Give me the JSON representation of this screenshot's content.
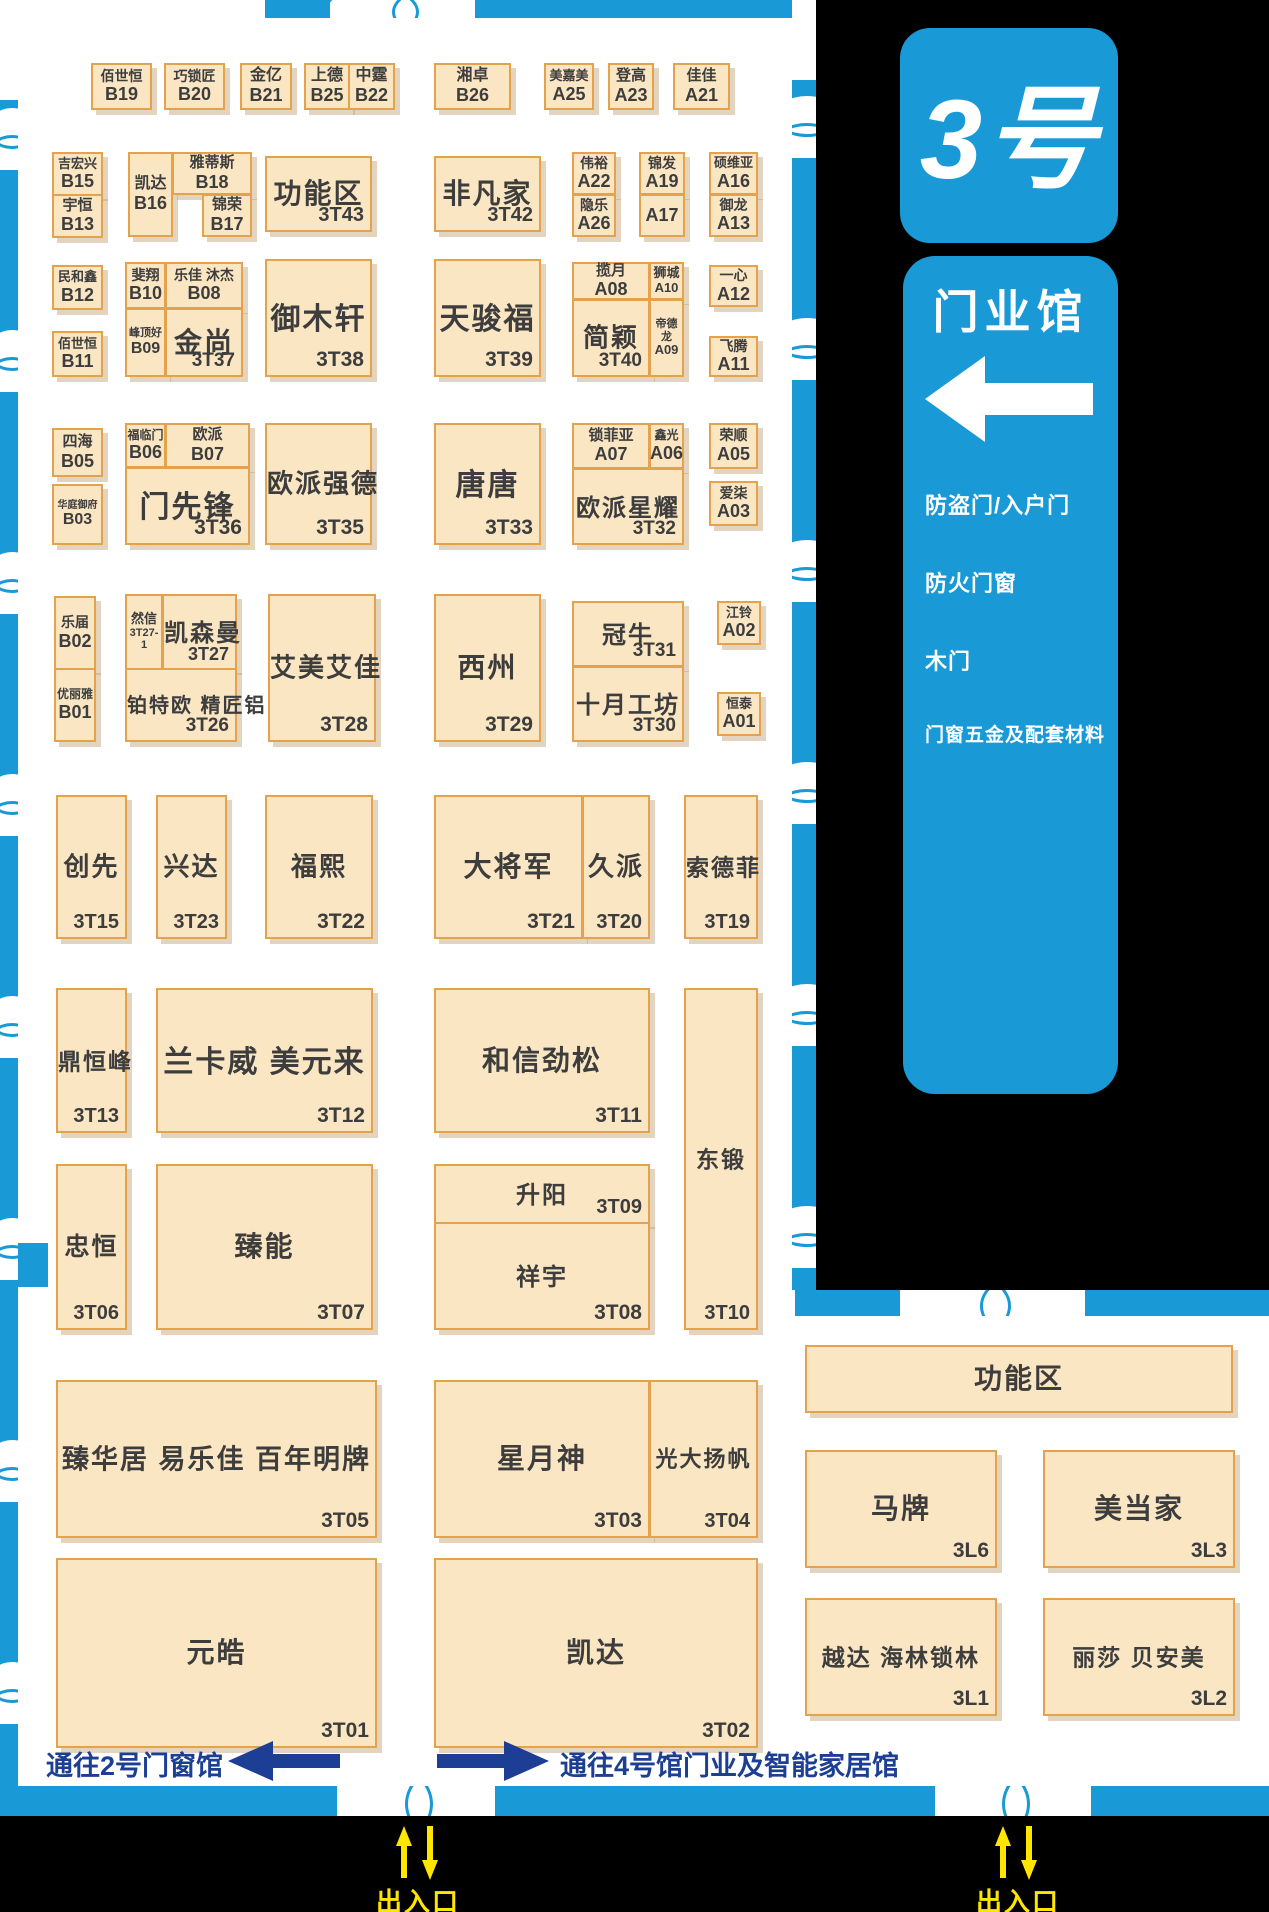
{
  "hall": {
    "number_label": "3号",
    "name": "门业馆",
    "categories": [
      "防盗门/入户门",
      "防火门窗",
      "木门",
      "门窗五金及配套材料"
    ]
  },
  "navigation": {
    "to_hall2": "通往2号门窗馆",
    "to_hall4": "通往4号馆门业及智能家居馆",
    "entrance_label": "出入口"
  },
  "colors": {
    "accent_blue": "#199ad7",
    "navy": "#1c3e94",
    "yellow": "#ffe600",
    "booth_fill": "#fae6c3",
    "booth_border": "#e3a24b",
    "black": "#000000"
  },
  "booths": [
    {
      "id": "B19",
      "name": "佰世恒",
      "x": 91,
      "y": 63,
      "w": 61,
      "h": 47,
      "big": false,
      "fs": 14
    },
    {
      "id": "B20",
      "name": "巧锁匠",
      "x": 164,
      "y": 63,
      "w": 61,
      "h": 47,
      "big": false,
      "fs": 14
    },
    {
      "id": "B21",
      "name": "金亿",
      "x": 240,
      "y": 63,
      "w": 52,
      "h": 47,
      "big": false,
      "fs": 16
    },
    {
      "id": "B25",
      "name": "上德",
      "x": 304,
      "y": 63,
      "w": 46,
      "h": 47,
      "big": false,
      "fs": 16
    },
    {
      "id": "B22",
      "name": "中霆",
      "x": 348,
      "y": 63,
      "w": 47,
      "h": 47,
      "big": false,
      "fs": 16
    },
    {
      "id": "B26",
      "name": "湘卓",
      "x": 434,
      "y": 63,
      "w": 77,
      "h": 47,
      "big": false,
      "fs": 16
    },
    {
      "id": "A25",
      "name": "美嘉美",
      "x": 544,
      "y": 63,
      "w": 50,
      "h": 47,
      "big": false,
      "fs": 13
    },
    {
      "id": "A23",
      "name": "登高",
      "x": 608,
      "y": 63,
      "w": 46,
      "h": 47,
      "big": false,
      "fs": 15
    },
    {
      "id": "A21",
      "name": "佳佳",
      "x": 673,
      "y": 63,
      "w": 57,
      "h": 47,
      "big": false,
      "fs": 15
    },
    {
      "id": "B15",
      "name": "吉宏兴",
      "x": 52,
      "y": 152,
      "w": 51,
      "h": 44,
      "big": false,
      "fs": 13
    },
    {
      "id": "B13",
      "name": "宇恒",
      "x": 52,
      "y": 194,
      "w": 51,
      "h": 44,
      "big": false,
      "fs": 15
    },
    {
      "id": "B16",
      "name": "凯达",
      "x": 128,
      "y": 152,
      "w": 45,
      "h": 85,
      "big": false,
      "fs": 16
    },
    {
      "id": "B18",
      "name": "雅蒂斯",
      "x": 172,
      "y": 152,
      "w": 80,
      "h": 43,
      "big": false,
      "fs": 15
    },
    {
      "id": "B17",
      "name": "锦荣",
      "x": 202,
      "y": 194,
      "w": 50,
      "h": 43,
      "big": false,
      "fs": 15
    },
    {
      "id": "3T43",
      "name": "功能区",
      "x": 265,
      "y": 156,
      "w": 107,
      "h": 76,
      "big": true,
      "fs": 28,
      "ifs": 20
    },
    {
      "id": "3T42",
      "name": "非凡家",
      "x": 434,
      "y": 156,
      "w": 107,
      "h": 76,
      "big": true,
      "fs": 28,
      "ifs": 20
    },
    {
      "id": "A22",
      "name": "伟裕",
      "x": 572,
      "y": 152,
      "w": 44,
      "h": 43,
      "big": false,
      "fs": 14
    },
    {
      "id": "A26",
      "name": "隐乐",
      "x": 572,
      "y": 194,
      "w": 44,
      "h": 43,
      "big": false,
      "fs": 14
    },
    {
      "id": "A19",
      "name": "锦发",
      "x": 639,
      "y": 152,
      "w": 46,
      "h": 43,
      "big": false,
      "fs": 14
    },
    {
      "id": "A17",
      "name": "",
      "x": 639,
      "y": 194,
      "w": 46,
      "h": 43,
      "big": false,
      "fs": 14
    },
    {
      "id": "A16",
      "name": "硕维亚",
      "x": 709,
      "y": 152,
      "w": 49,
      "h": 43,
      "big": false,
      "fs": 13
    },
    {
      "id": "A13",
      "name": "御龙",
      "x": 709,
      "y": 194,
      "w": 49,
      "h": 43,
      "big": false,
      "fs": 14
    },
    {
      "id": "B12",
      "name": "民和鑫",
      "x": 52,
      "y": 265,
      "w": 51,
      "h": 45,
      "big": false,
      "fs": 13
    },
    {
      "id": "B11",
      "name": "佰世恒",
      "x": 52,
      "y": 331,
      "w": 51,
      "h": 46,
      "big": false,
      "fs": 13
    },
    {
      "id": "B10",
      "name": "斐翔",
      "x": 125,
      "y": 262,
      "w": 41,
      "h": 47,
      "big": false,
      "fs": 14
    },
    {
      "id": "B08",
      "name": "乐佳 沐杰",
      "x": 165,
      "y": 262,
      "w": 78,
      "h": 47,
      "big": false,
      "fs": 14
    },
    {
      "id": "B09",
      "name": "峰顶好",
      "x": 125,
      "y": 308,
      "w": 41,
      "h": 69,
      "big": false,
      "fs": 11,
      "ifs": 16
    },
    {
      "id": "3T37",
      "name": "金尚",
      "x": 165,
      "y": 308,
      "w": 78,
      "h": 69,
      "big": true,
      "fs": 28,
      "ifs": 19
    },
    {
      "id": "3T38",
      "name": "御木轩",
      "x": 265,
      "y": 259,
      "w": 107,
      "h": 118,
      "big": true,
      "fs": 30,
      "ifs": 21
    },
    {
      "id": "3T39",
      "name": "天骏福",
      "x": 434,
      "y": 259,
      "w": 107,
      "h": 118,
      "big": true,
      "fs": 30,
      "ifs": 21
    },
    {
      "id": "A08",
      "name": "揽月",
      "x": 572,
      "y": 262,
      "w": 78,
      "h": 38,
      "big": false,
      "fs": 15
    },
    {
      "id": "3T40",
      "name": "简颖",
      "x": 572,
      "y": 299,
      "w": 78,
      "h": 78,
      "big": true,
      "fs": 26,
      "ifs": 19
    },
    {
      "id": "A10",
      "name": "狮城",
      "x": 649,
      "y": 262,
      "w": 35,
      "h": 38,
      "big": false,
      "fs": 13,
      "ifs": 13
    },
    {
      "id": "A09",
      "name": "帝德龙",
      "x": 649,
      "y": 299,
      "w": 35,
      "h": 78,
      "big": false,
      "fs": 11,
      "ifs": 13
    },
    {
      "id": "A12",
      "name": "一心",
      "x": 709,
      "y": 265,
      "w": 49,
      "h": 42,
      "big": false,
      "fs": 14
    },
    {
      "id": "A11",
      "name": "飞腾",
      "x": 709,
      "y": 336,
      "w": 49,
      "h": 41,
      "big": false,
      "fs": 14
    },
    {
      "id": "B05",
      "name": "四海",
      "x": 52,
      "y": 428,
      "w": 51,
      "h": 49,
      "big": false,
      "fs": 15
    },
    {
      "id": "B03",
      "name": "华庭御府",
      "x": 52,
      "y": 484,
      "w": 51,
      "h": 61,
      "big": false,
      "fs": 10,
      "ifs": 16
    },
    {
      "id": "B06",
      "name": "福临门",
      "x": 125,
      "y": 423,
      "w": 41,
      "h": 45,
      "big": false,
      "fs": 12
    },
    {
      "id": "B07",
      "name": "欧派",
      "x": 165,
      "y": 423,
      "w": 85,
      "h": 45,
      "big": false,
      "fs": 15
    },
    {
      "id": "3T36",
      "name": "门先锋",
      "x": 125,
      "y": 467,
      "w": 125,
      "h": 78,
      "big": true,
      "fs": 30,
      "ifs": 21
    },
    {
      "id": "3T35",
      "name": "欧派强德",
      "x": 265,
      "y": 423,
      "w": 107,
      "h": 122,
      "big": true,
      "fs": 26,
      "ifs": 21
    },
    {
      "id": "3T33",
      "name": "唐唐",
      "x": 434,
      "y": 423,
      "w": 107,
      "h": 122,
      "big": true,
      "fs": 30,
      "ifs": 21
    },
    {
      "id": "A07",
      "name": "锁菲亚",
      "x": 572,
      "y": 423,
      "w": 78,
      "h": 46,
      "big": false,
      "fs": 15
    },
    {
      "id": "A06",
      "name": "鑫光",
      "x": 649,
      "y": 423,
      "w": 35,
      "h": 46,
      "big": false,
      "fs": 12
    },
    {
      "id": "3T32",
      "name": "欧派星耀",
      "x": 572,
      "y": 468,
      "w": 112,
      "h": 77,
      "big": true,
      "fs": 24,
      "ifs": 19
    },
    {
      "id": "A05",
      "name": "荣顺",
      "x": 709,
      "y": 423,
      "w": 49,
      "h": 46,
      "big": false,
      "fs": 14
    },
    {
      "id": "A03",
      "name": "爱柒",
      "x": 709,
      "y": 481,
      "w": 49,
      "h": 45,
      "big": false,
      "fs": 14
    },
    {
      "id": "B02",
      "name": "乐届",
      "x": 54,
      "y": 596,
      "w": 42,
      "h": 74,
      "big": false,
      "fs": 14
    },
    {
      "id": "B01",
      "name": "优丽雅",
      "x": 54,
      "y": 668,
      "w": 42,
      "h": 74,
      "big": false,
      "fs": 12
    },
    {
      "id": "3T27-1",
      "name": "然信",
      "x": 125,
      "y": 594,
      "w": 38,
      "h": 76,
      "big": false,
      "fs": 13,
      "ifs": 11
    },
    {
      "id": "3T27",
      "name": "凯森曼",
      "x": 162,
      "y": 594,
      "w": 75,
      "h": 76,
      "big": true,
      "fs": 24,
      "ifs": 18
    },
    {
      "id": "3T26",
      "name": "铂特欧  精匠铝",
      "x": 125,
      "y": 668,
      "w": 112,
      "h": 74,
      "big": true,
      "fs": 20,
      "ifs": 19
    },
    {
      "id": "3T28",
      "name": "艾美艾佳",
      "x": 268,
      "y": 594,
      "w": 108,
      "h": 148,
      "big": true,
      "fs": 26,
      "ifs": 21
    },
    {
      "id": "3T29",
      "name": "西州",
      "x": 434,
      "y": 594,
      "w": 107,
      "h": 148,
      "big": true,
      "fs": 28,
      "ifs": 21
    },
    {
      "id": "3T31",
      "name": "冠牛",
      "x": 572,
      "y": 601,
      "w": 112,
      "h": 66,
      "big": true,
      "fs": 24,
      "ifs": 19
    },
    {
      "id": "3T30",
      "name": "十月工坊",
      "x": 572,
      "y": 666,
      "w": 112,
      "h": 76,
      "big": true,
      "fs": 24,
      "ifs": 19
    },
    {
      "id": "A02",
      "name": "江铃",
      "x": 717,
      "y": 601,
      "w": 44,
      "h": 44,
      "big": false,
      "fs": 13
    },
    {
      "id": "A01",
      "name": "恒泰",
      "x": 717,
      "y": 692,
      "w": 44,
      "h": 44,
      "big": false,
      "fs": 13
    },
    {
      "id": "3T15",
      "name": "创先",
      "x": 56,
      "y": 795,
      "w": 71,
      "h": 144,
      "big": true,
      "fs": 26,
      "ifs": 20
    },
    {
      "id": "3T23",
      "name": "兴达",
      "x": 156,
      "y": 795,
      "w": 71,
      "h": 144,
      "big": true,
      "fs": 26,
      "ifs": 20
    },
    {
      "id": "3T22",
      "name": "福熙",
      "x": 265,
      "y": 795,
      "w": 108,
      "h": 144,
      "big": true,
      "fs": 26,
      "ifs": 21
    },
    {
      "id": "3T21",
      "name": "大将军",
      "x": 434,
      "y": 795,
      "w": 149,
      "h": 144,
      "big": true,
      "fs": 28,
      "ifs": 21
    },
    {
      "id": "3T20",
      "name": "久派",
      "x": 582,
      "y": 795,
      "w": 68,
      "h": 144,
      "big": true,
      "fs": 26,
      "ifs": 20
    },
    {
      "id": "3T19",
      "name": "索德菲",
      "x": 684,
      "y": 795,
      "w": 74,
      "h": 144,
      "big": true,
      "fs": 23,
      "ifs": 20
    },
    {
      "id": "3T13",
      "name": "鼎恒峰",
      "x": 56,
      "y": 988,
      "w": 71,
      "h": 145,
      "big": true,
      "fs": 23,
      "ifs": 20
    },
    {
      "id": "3T12",
      "name": "兰卡威  美元来",
      "x": 156,
      "y": 988,
      "w": 217,
      "h": 145,
      "big": true,
      "fs": 30,
      "ifs": 21
    },
    {
      "id": "3T11",
      "name": "和信劲松",
      "x": 434,
      "y": 988,
      "w": 216,
      "h": 145,
      "big": true,
      "fs": 28,
      "ifs": 21
    },
    {
      "id": "3T10",
      "name": "东锻",
      "x": 684,
      "y": 988,
      "w": 74,
      "h": 342,
      "big": true,
      "fs": 23,
      "ifs": 20
    },
    {
      "id": "3T06",
      "name": "忠恒",
      "x": 56,
      "y": 1164,
      "w": 71,
      "h": 166,
      "big": true,
      "fs": 25,
      "ifs": 20
    },
    {
      "id": "3T07",
      "name": "臻能",
      "x": 156,
      "y": 1164,
      "w": 217,
      "h": 166,
      "big": true,
      "fs": 28,
      "ifs": 21
    },
    {
      "id": "3T09",
      "name": "升阳",
      "x": 434,
      "y": 1164,
      "w": 216,
      "h": 60,
      "big": true,
      "fs": 24,
      "ifs": 20
    },
    {
      "id": "3T08",
      "name": "祥宇",
      "x": 434,
      "y": 1222,
      "w": 216,
      "h": 108,
      "big": true,
      "fs": 24,
      "ifs": 21
    },
    {
      "id": "3T05",
      "name": "臻华居 易乐佳 百年明牌",
      "x": 56,
      "y": 1380,
      "w": 321,
      "h": 158,
      "big": true,
      "fs": 27,
      "ifs": 21
    },
    {
      "id": "3T03",
      "name": "星月神",
      "x": 434,
      "y": 1380,
      "w": 216,
      "h": 158,
      "big": true,
      "fs": 28,
      "ifs": 21
    },
    {
      "id": "3T04",
      "name": "光大扬帆",
      "x": 649,
      "y": 1380,
      "w": 109,
      "h": 158,
      "big": true,
      "fs": 22,
      "ifs": 20
    },
    {
      "id": "3T01",
      "name": "元皓",
      "x": 56,
      "y": 1558,
      "w": 321,
      "h": 190,
      "big": true,
      "fs": 28,
      "ifs": 21
    },
    {
      "id": "3T02",
      "name": "凯达",
      "x": 434,
      "y": 1558,
      "w": 324,
      "h": 190,
      "big": true,
      "fs": 28,
      "ifs": 21
    },
    {
      "id": "",
      "name": "功能区",
      "x": 805,
      "y": 1345,
      "w": 428,
      "h": 68,
      "big": true,
      "fs": 28,
      "ifs": 21
    },
    {
      "id": "3L6",
      "name": "马牌",
      "x": 805,
      "y": 1450,
      "w": 192,
      "h": 118,
      "big": true,
      "fs": 28,
      "ifs": 21
    },
    {
      "id": "3L3",
      "name": "美当家",
      "x": 1043,
      "y": 1450,
      "w": 192,
      "h": 118,
      "big": true,
      "fs": 28,
      "ifs": 21
    },
    {
      "id": "3L1",
      "name": "越达 海林锁林",
      "x": 805,
      "y": 1598,
      "w": 192,
      "h": 118,
      "big": true,
      "fs": 23,
      "ifs": 21
    },
    {
      "id": "3L2",
      "name": "丽莎 贝安美",
      "x": 1043,
      "y": 1598,
      "w": 192,
      "h": 118,
      "big": true,
      "fs": 23,
      "ifs": 21
    }
  ]
}
